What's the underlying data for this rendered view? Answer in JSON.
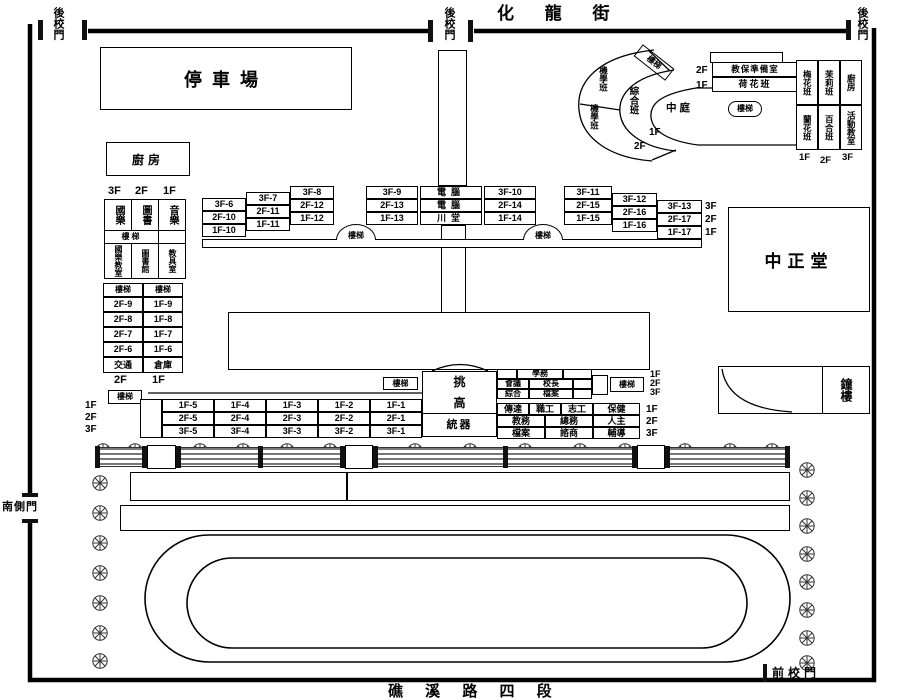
{
  "streets": {
    "top": "化 龍 街",
    "bottom": "礁 溪 路 四 段"
  },
  "gates": {
    "back": "後校門",
    "front": "前校門",
    "south": "南側門"
  },
  "labels": {
    "stairs": "樓梯",
    "parking": "停車場",
    "kitchen": "廚房",
    "auditorium": "中正堂",
    "bell_tower": "鐘樓",
    "courtyard": "中庭"
  },
  "west_upper": {
    "floors": [
      "3F",
      "2F",
      "1F"
    ],
    "row1": [
      "國樂",
      "圖書",
      "音樂"
    ],
    "row2": [
      "國樂教室",
      "圖書館",
      "教具室"
    ]
  },
  "west_lower": {
    "rows": [
      [
        "2F-9",
        "1F-9"
      ],
      [
        "2F-8",
        "1F-8"
      ],
      [
        "2F-7",
        "1F-7"
      ],
      [
        "2F-6",
        "1F-6"
      ],
      [
        "交通",
        "倉庫"
      ]
    ],
    "floors": [
      "2F",
      "1F"
    ]
  },
  "north": {
    "blocks": [
      [
        "3F-6",
        "2F-10",
        "1F-10"
      ],
      [
        "3F-7",
        "2F-11",
        "1F-11"
      ],
      [
        "3F-8",
        "2F-12",
        "1F-12"
      ],
      [
        "3F-9",
        "2F-13",
        "1F-13"
      ],
      [
        "電腦",
        "電腦",
        "川堂"
      ],
      [
        "3F-10",
        "2F-14",
        "1F-14"
      ],
      [
        "3F-11",
        "2F-15",
        "1F-15"
      ],
      [
        "3F-12",
        "2F-16",
        "1F-16"
      ],
      [
        "3F-13",
        "2F-17",
        "1F-17"
      ]
    ],
    "floors": [
      "3F",
      "2F",
      "1F"
    ]
  },
  "south": {
    "rows": [
      [
        "1F-5",
        "1F-4",
        "1F-3",
        "1F-2",
        "1F-1"
      ],
      [
        "2F-5",
        "2F-4",
        "2F-3",
        "2F-2",
        "2F-1"
      ],
      [
        "3F-5",
        "3F-4",
        "3F-3",
        "3F-2",
        "3F-1"
      ]
    ],
    "floors": [
      "1F",
      "2F",
      "3F"
    ]
  },
  "tower": {
    "top": "挑",
    "mid": "高",
    "bottom": "統器"
  },
  "admin_upper": {
    "r1": "學務",
    "r2": [
      "會議",
      "校長"
    ],
    "r3": [
      "綜合",
      "檔案"
    ],
    "floors": [
      "1F",
      "2F",
      "3F"
    ]
  },
  "admin_lower": {
    "rows": [
      [
        "傳達",
        "職工",
        "志工",
        "保健"
      ],
      [
        "教務",
        "總務",
        "人主"
      ],
      [
        "檔案",
        "諮商",
        "輔導"
      ]
    ],
    "floors": [
      "1F",
      "2F",
      "3F"
    ]
  },
  "kg": {
    "fan_cells": [
      "機學班",
      "綜合班",
      "機學班"
    ],
    "fan_floors": [
      "1F",
      "2F"
    ],
    "north_rooms": [
      [
        "2F",
        "教保準備室"
      ],
      [
        "1F",
        "荷花班"
      ]
    ],
    "east_cols": [
      [
        "梅花班",
        "蘭花班"
      ],
      [
        "茉莉班",
        "百合班"
      ],
      [
        "廚房",
        "活動教室"
      ]
    ],
    "east_floors": [
      "1F",
      "2F",
      "3F"
    ]
  }
}
